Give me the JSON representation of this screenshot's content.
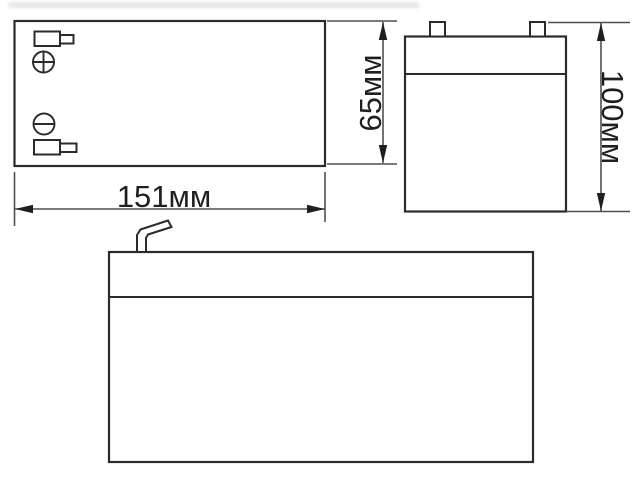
{
  "drawing": {
    "title": "battery dimensional drawing",
    "dimensions": {
      "length": "151мм",
      "width": "65мм",
      "height": "100мм"
    }
  },
  "icons": {
    "positive_terminal_screw": "plus-screw-icon",
    "negative_terminal_screw": "minus-screw-icon"
  },
  "colors": {
    "background": "#ffffff",
    "outline": "#2b2b2b",
    "detail": "#2b2b2b",
    "dimension_line": "#4f4f4f",
    "arrow": "#1f1f1f",
    "text": "#1f1f1f",
    "watermark_smudge": "#d2d2d2"
  }
}
